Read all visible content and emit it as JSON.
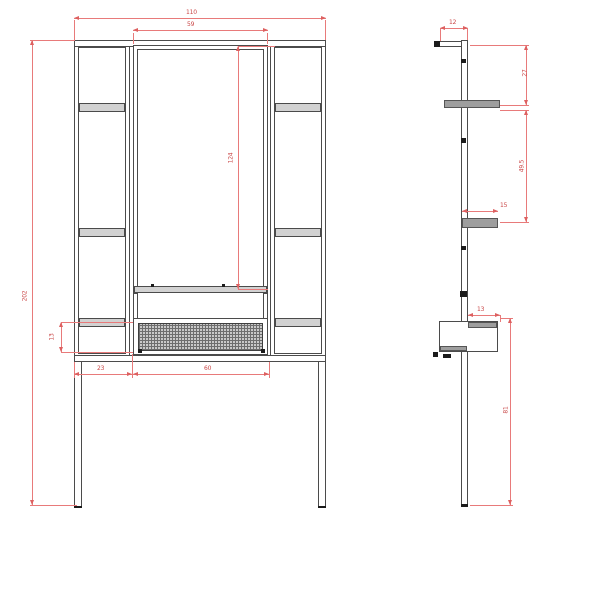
{
  "drawing": {
    "type": "furniture-technical-drawing",
    "views": [
      "front",
      "side"
    ],
    "colors": {
      "background": "#ffffff",
      "structure_line": "#4b4b4b",
      "shelf_fill": "#d2d2d2",
      "dimension_line": "#e87a7a",
      "dimension_text": "#c94747"
    },
    "dims": {
      "front": {
        "overall_width": "110",
        "mirror_width": "59",
        "overall_height": "202",
        "mirror_height": "124",
        "drawer_height": "13",
        "offset_left": "23",
        "drawer_width": "60"
      },
      "side": {
        "top_depth": "12",
        "upper_section_height": "27",
        "mid_section_height": "49.5",
        "shelf_depth": "15",
        "table_depth": "13",
        "leg_height": "81"
      }
    }
  }
}
